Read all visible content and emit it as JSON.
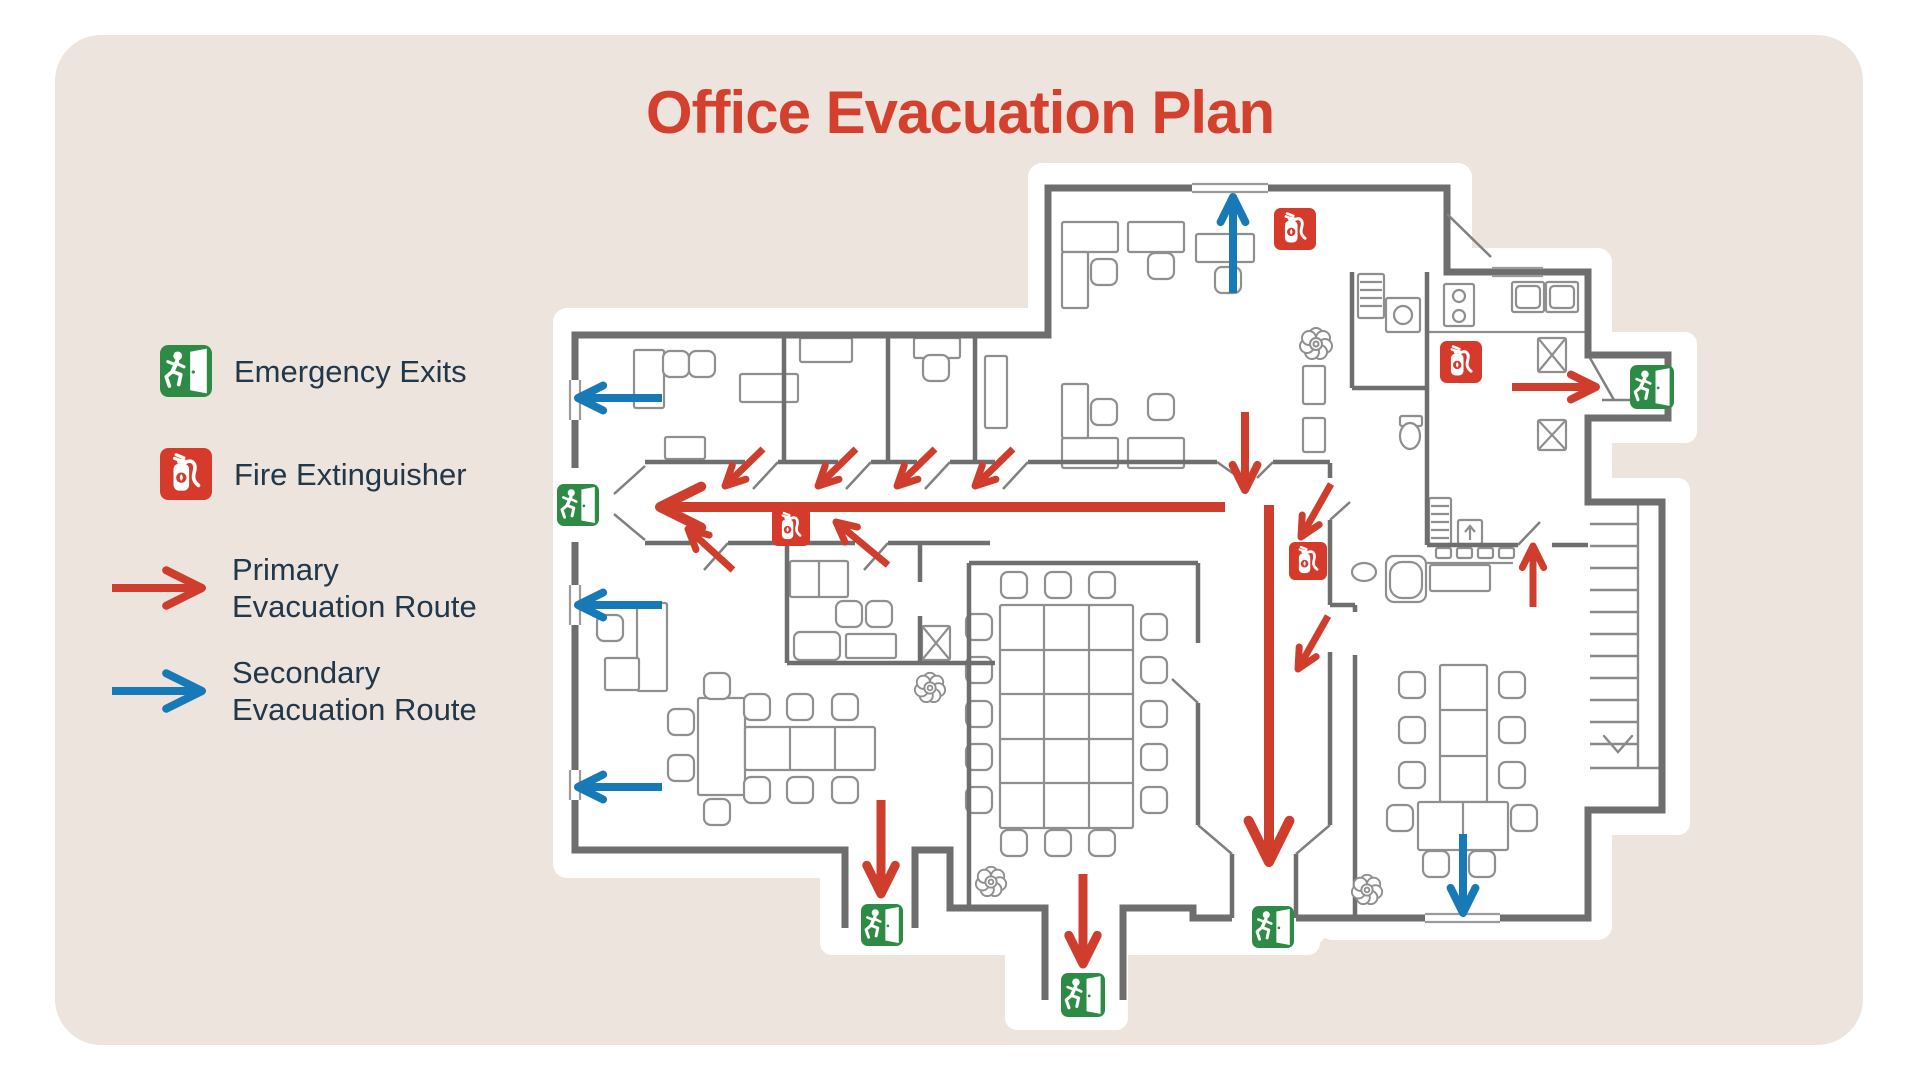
{
  "title": "Office Evacuation Plan",
  "colors": {
    "card_background": "#ece4dd",
    "title": "#d4402e",
    "text": "#21374a",
    "primary_route": "#cf3e2d",
    "secondary_route": "#1779b5",
    "exit_green": "#2e8b45",
    "extinguisher_red": "#d63a2a"
  },
  "legend": {
    "items": [
      {
        "label": "Emergency Exits",
        "icon": "exit-sign-icon"
      },
      {
        "label": "Fire Extinguisher",
        "icon": "fire-extinguisher-icon"
      },
      {
        "label_line1": "Primary",
        "label_line2": "Evacuation Route",
        "icon": "primary-route-arrow-icon"
      },
      {
        "label_line1": "Secondary",
        "label_line2": "Evacuation Route",
        "icon": "secondary-route-arrow-icon"
      }
    ]
  },
  "map": {
    "emergency_exits": [
      {
        "x": 578,
        "y": 505,
        "size": 42
      },
      {
        "x": 1652,
        "y": 387,
        "size": 44
      },
      {
        "x": 882,
        "y": 925,
        "size": 42
      },
      {
        "x": 1083,
        "y": 995,
        "size": 44
      },
      {
        "x": 1273,
        "y": 927,
        "size": 42
      }
    ],
    "fire_extinguishers": [
      {
        "x": 1295,
        "y": 229,
        "size": 42
      },
      {
        "x": 1461,
        "y": 362,
        "size": 42
      },
      {
        "x": 791,
        "y": 527,
        "size": 38
      },
      {
        "x": 1308,
        "y": 561,
        "size": 38
      }
    ],
    "primary_route_arrows": [
      {
        "x1": 1225,
        "y1": 507,
        "x2": 660,
        "y2": 507,
        "w": 10,
        "head": 46
      },
      {
        "x1": 763,
        "y1": 449,
        "x2": 725,
        "y2": 486,
        "w": 7,
        "head": 22
      },
      {
        "x1": 856,
        "y1": 449,
        "x2": 818,
        "y2": 486,
        "w": 7,
        "head": 22
      },
      {
        "x1": 935,
        "y1": 449,
        "x2": 897,
        "y2": 486,
        "w": 7,
        "head": 22
      },
      {
        "x1": 1013,
        "y1": 449,
        "x2": 975,
        "y2": 486,
        "w": 7,
        "head": 22
      },
      {
        "x1": 733,
        "y1": 570,
        "x2": 688,
        "y2": 529,
        "w": 7,
        "head": 22
      },
      {
        "x1": 888,
        "y1": 565,
        "x2": 836,
        "y2": 522,
        "w": 7,
        "head": 22
      },
      {
        "x1": 1245,
        "y1": 412,
        "x2": 1245,
        "y2": 490,
        "w": 8,
        "head": 28
      },
      {
        "x1": 1269,
        "y1": 505,
        "x2": 1269,
        "y2": 862,
        "w": 10,
        "head": 46
      },
      {
        "x1": 1331,
        "y1": 484,
        "x2": 1301,
        "y2": 537,
        "w": 7,
        "head": 22
      },
      {
        "x1": 1328,
        "y1": 616,
        "x2": 1298,
        "y2": 669,
        "w": 7,
        "head": 22
      },
      {
        "x1": 881,
        "y1": 800,
        "x2": 881,
        "y2": 894,
        "w": 9,
        "head": 32
      },
      {
        "x1": 1083,
        "y1": 874,
        "x2": 1083,
        "y2": 964,
        "w": 9,
        "head": 32
      },
      {
        "x1": 1512,
        "y1": 387,
        "x2": 1596,
        "y2": 387,
        "w": 8,
        "head": 28
      },
      {
        "x1": 1533,
        "y1": 607,
        "x2": 1533,
        "y2": 546,
        "w": 7,
        "head": 24
      }
    ],
    "secondary_route_arrows": [
      {
        "x1": 1233,
        "y1": 293,
        "x2": 1233,
        "y2": 197,
        "w": 8,
        "head": 28
      },
      {
        "x1": 662,
        "y1": 398,
        "x2": 578,
        "y2": 398,
        "w": 8,
        "head": 28
      },
      {
        "x1": 662,
        "y1": 605,
        "x2": 578,
        "y2": 605,
        "w": 8,
        "head": 28
      },
      {
        "x1": 662,
        "y1": 787,
        "x2": 578,
        "y2": 787,
        "w": 8,
        "head": 28
      },
      {
        "x1": 1463,
        "y1": 834,
        "x2": 1463,
        "y2": 913,
        "w": 8,
        "head": 28
      }
    ]
  }
}
